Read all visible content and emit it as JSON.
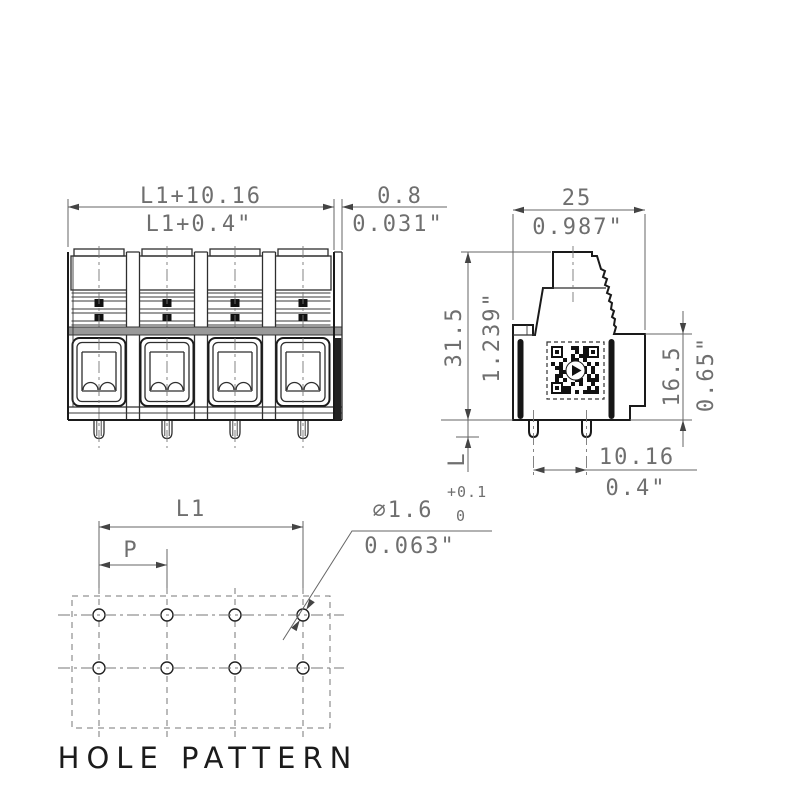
{
  "drawing": {
    "caption": "HOLE PATTERN",
    "dimensions": {
      "front_width": {
        "metric": "L1+10.16",
        "inch": "L1+0.4\""
      },
      "end_plate": {
        "metric": "0.8",
        "inch": "0.031\""
      },
      "depth": {
        "metric": "25",
        "inch": "0.987\""
      },
      "total_height": {
        "metric": "31.5",
        "inch": "1.239\""
      },
      "body_height": {
        "metric": "16.5",
        "inch": "0.65\""
      },
      "pin_row_spacing": {
        "metric": "10.16",
        "inch": "0.4\""
      },
      "pin_length": {
        "metric": "L"
      },
      "hole_span": {
        "metric": "L1"
      },
      "hole_pitch": {
        "metric": "P"
      },
      "hole_diameter": {
        "metric": "⌀1.6",
        "tol_plus": "+0.1",
        "tol_minus": "0",
        "inch": "0.063\""
      }
    },
    "front_view": {
      "poles": 4
    },
    "hole_pattern": {
      "columns": 4,
      "rows": 2
    },
    "colors": {
      "outline": "#1a1a1a",
      "dimension": "#666666",
      "text": "#6f6f6f",
      "fill": "#ffffff",
      "dark_fill": "#1c1c1c"
    }
  }
}
